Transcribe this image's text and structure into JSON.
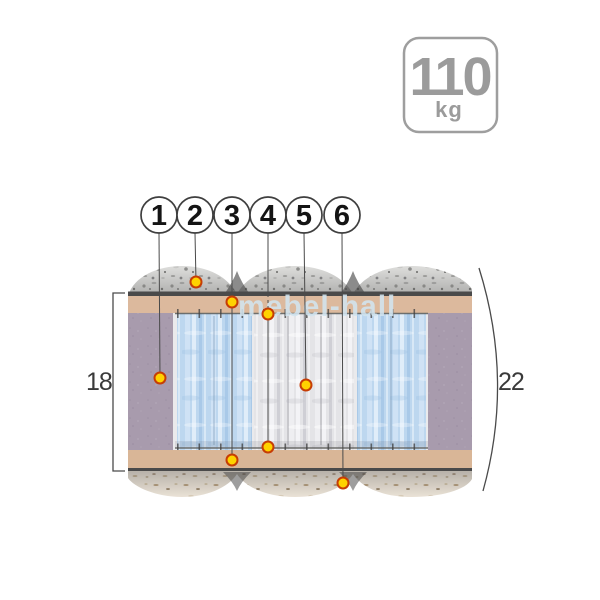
{
  "watermark": "mebel-hall",
  "weight_badge": {
    "value": "110",
    "unit": "kg"
  },
  "callout_numbers": [
    "1",
    "2",
    "3",
    "4",
    "5",
    "6"
  ],
  "dimensions": {
    "inner_height_cm": "18",
    "total_height_cm": "22"
  },
  "colors": {
    "marker_fill": "#FFD200",
    "marker_ring": "#C63D05",
    "foam_side_purple": "#A89BAD",
    "felt_layer_tan": "#DCB99D",
    "spring_block_blue": "#BDD7EF",
    "spring_block_white": "#E4E4E7",
    "quilt_top_granite": "#DBDBD9",
    "quilt_bottom_cream": "#EAE2D6",
    "outline_dark": "#4A4A4A",
    "badge_gray": "#9B9B9B"
  }
}
